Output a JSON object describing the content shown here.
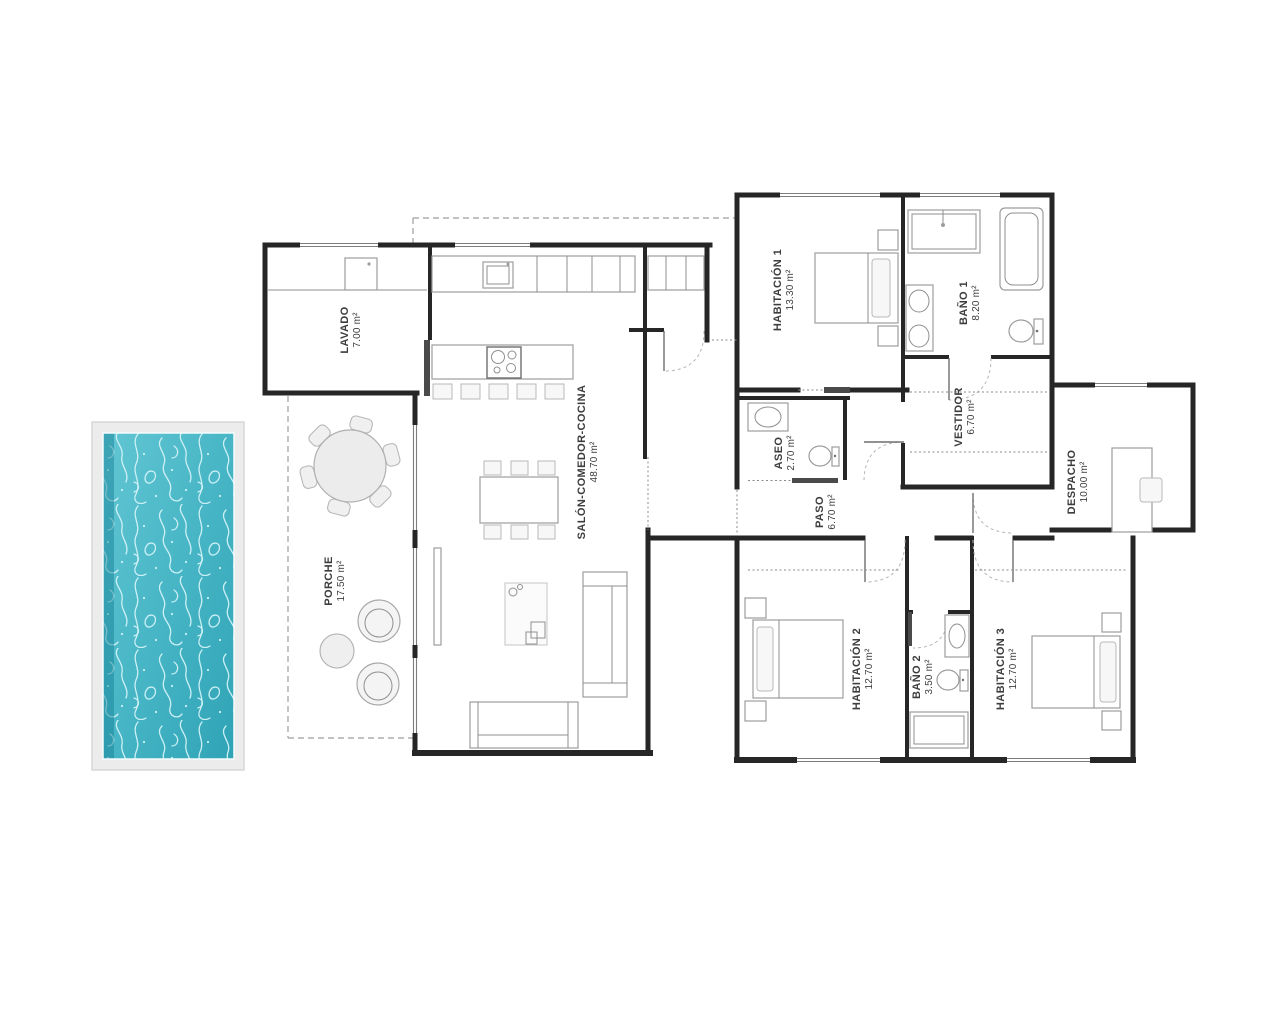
{
  "plan": {
    "title": "Single-storey house floor plan with pool",
    "rooms": [
      {
        "id": "lavado",
        "name": "LAVADO",
        "area": "7.00 m²"
      },
      {
        "id": "salon",
        "name": "SALÓN-COMEDOR-COCINA",
        "area": "48.70 m²"
      },
      {
        "id": "porche",
        "name": "PORCHE",
        "area": "17.50 m²"
      },
      {
        "id": "habitacion1",
        "name": "HABITACIÓN 1",
        "area": "13.30 m²"
      },
      {
        "id": "bano1",
        "name": "BAÑO 1",
        "area": "8.20 m²"
      },
      {
        "id": "vestidor",
        "name": "VESTIDOR",
        "area": "6.70 m²"
      },
      {
        "id": "aseo",
        "name": "ASEO",
        "area": "2.70 m²"
      },
      {
        "id": "paso",
        "name": "PASO",
        "area": "6.70 m²"
      },
      {
        "id": "despacho",
        "name": "DESPACHO",
        "area": "10.00 m²"
      },
      {
        "id": "habitacion2",
        "name": "HABITACIÓN 2",
        "area": "12.70 m²"
      },
      {
        "id": "bano2",
        "name": "BAÑO 2",
        "area": "3.50 m²"
      },
      {
        "id": "habitacion3",
        "name": "HABITACIÓN 3",
        "area": "12.70 m²"
      }
    ],
    "colors": {
      "wall": "#262626",
      "furniture": "#9c9c9c",
      "label": "#3d3d3d",
      "pool_deck": "#ececec",
      "pool_water_light": "#62c6d3",
      "pool_water_dark": "#2fa3b6",
      "pool_caustics": "#d2f3f7"
    }
  }
}
